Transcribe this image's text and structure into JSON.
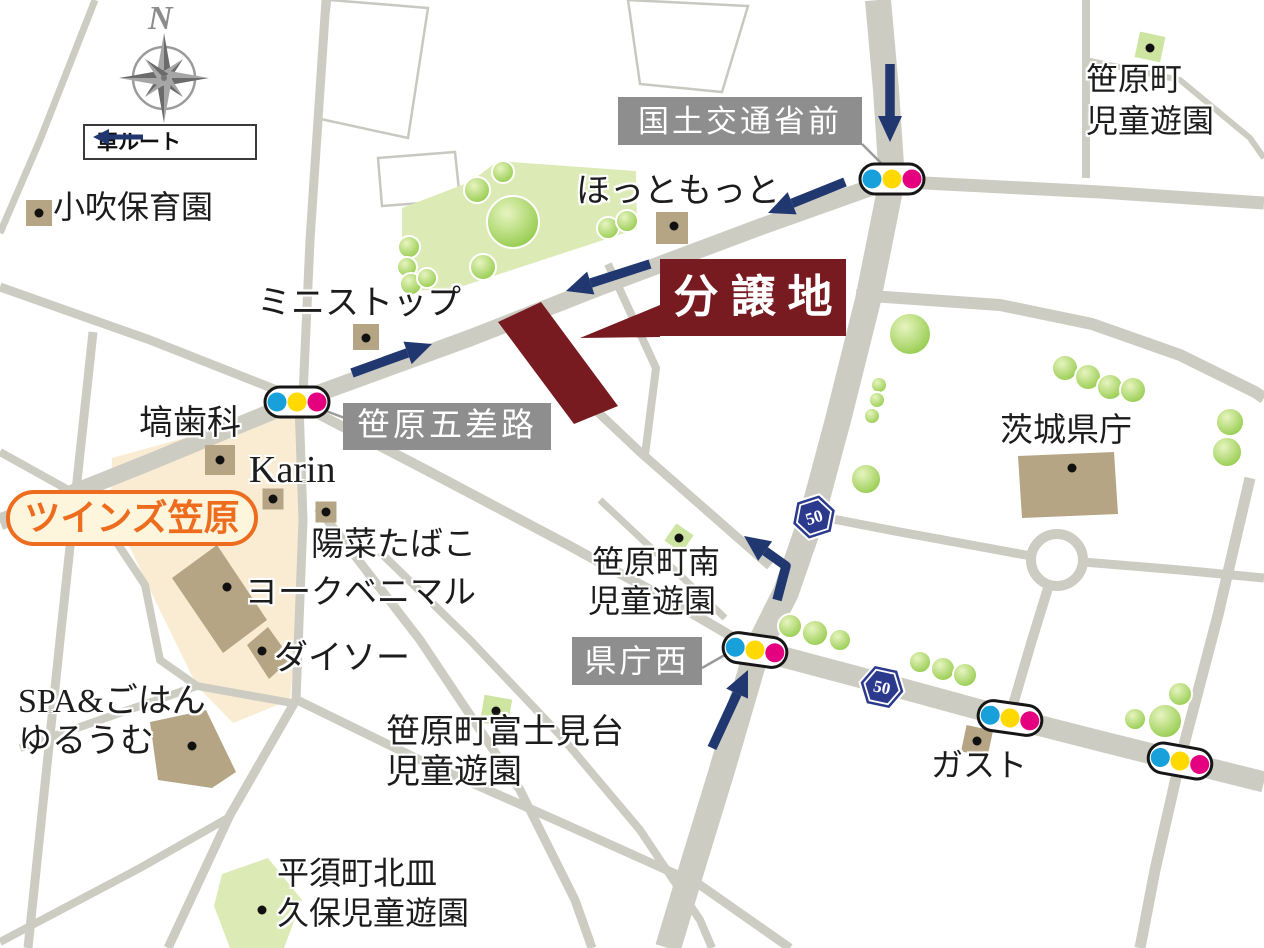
{
  "compass": {
    "north": "N"
  },
  "legend": {
    "car_route": "車ルート"
  },
  "sale": {
    "label": "分譲地"
  },
  "route_shield": {
    "number": "50"
  },
  "intersections": {
    "kokudo_mae": "国土交通省前",
    "gosaro": "笹原五差路",
    "kencho_nishi": "県庁西"
  },
  "badges": {
    "twins_kasahara": "ツインズ笠原"
  },
  "pois": {
    "kobuki_hoikuen": "小吹保育園",
    "sasahara_cho_park_1": "笹原町",
    "sasahara_cho_park_2": "児童遊園",
    "hotto_motto": "ほっともっと",
    "ministop": "ミニストップ",
    "hanawa_dental": "塙歯科",
    "karin": "Karin",
    "hina_tabako": "陽菜たばこ",
    "york_benimaru": "ヨークベニマル",
    "daiso": "ダイソー",
    "spa_gohan_1": "SPA&ごはん",
    "spa_gohan_2": "ゆるうむ",
    "sasahara_minami_1": "笹原町南",
    "sasahara_minami_2": "児童遊園",
    "ibaraki_kencho": "茨城県庁",
    "fujimidai_1": "笹原町富士見台",
    "fujimidai_2": "児童遊園",
    "gusto": "ガスト",
    "hirasu_1": "平須町北皿",
    "hirasu_2": "久保児童遊園"
  },
  "colors": {
    "road": "#cdccc3",
    "park": "#dcebb6",
    "park_marker": "#cde5a1",
    "building": "#b5a584",
    "shopping_area": "#faecd3",
    "sale_maroon": "#771b20",
    "route_arrow_navy": "#20376f",
    "label_box_gray": "#8e8e8e",
    "shield_blue": "#2c3a8e",
    "signal_blue": "#18a0da",
    "signal_yellow": "#ffd900",
    "signal_pink": "#e4007f",
    "badge_orange": "#ed6c1e",
    "badge_cream": "#fdf6dc",
    "tree_green": "#8ac63e",
    "tree_light": "#e7f4c0",
    "compass_gray": "#9b9b9b",
    "text_black": "#1c1c1c"
  }
}
